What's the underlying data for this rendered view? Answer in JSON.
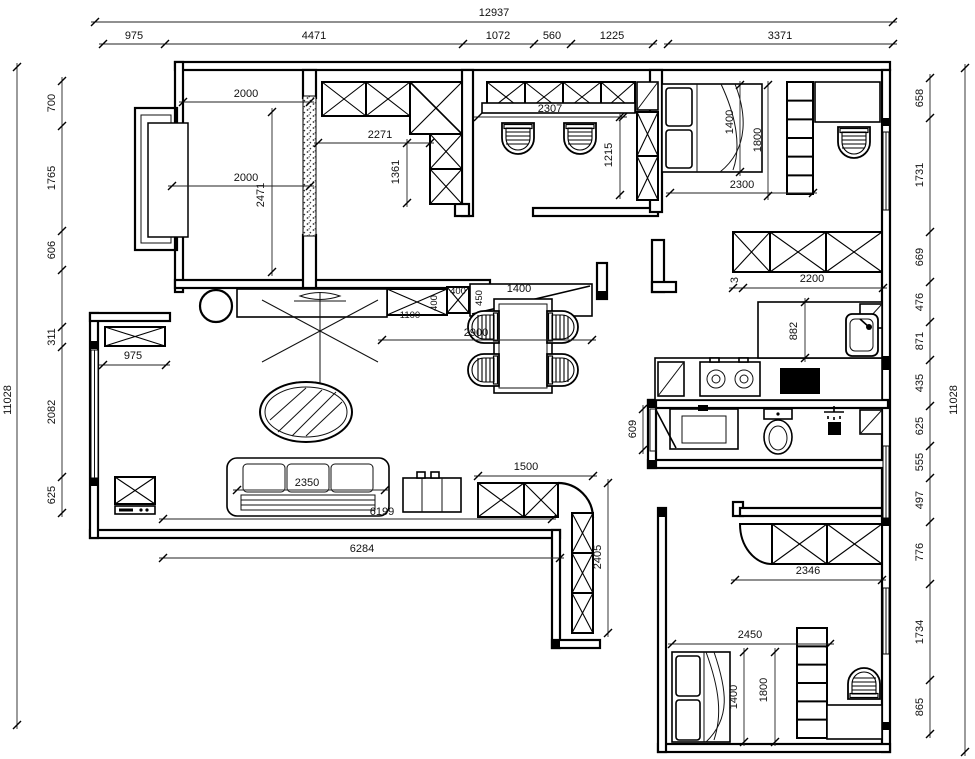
{
  "dims": {
    "top_total": "12937",
    "top": [
      "975",
      "4471",
      "1072",
      "560",
      "1225",
      "3371"
    ],
    "left_total": "11028",
    "left": [
      "700",
      "1765",
      "606",
      "311",
      "2082",
      "625"
    ],
    "right_total": "11028",
    "right": [
      "658",
      "1731",
      "669",
      "476",
      "871",
      "435",
      "625",
      "555",
      "497",
      "776",
      "1734",
      "865"
    ],
    "master": {
      "w1": "2000",
      "w2": "2000",
      "depth": "2471"
    },
    "study": {
      "w": "2271",
      "h": "1361"
    },
    "office": {
      "w": "2307",
      "h": "1215"
    },
    "bedroom_top": {
      "bed_w": "1400",
      "bed_l": "1800",
      "clear": "2300",
      "gap": "3",
      "wardrobe": "2200"
    },
    "kitchen": {
      "counter_h": "882"
    },
    "bath": {
      "door_w": "609"
    },
    "entry": {
      "shoe_cab": "975",
      "console": "1100",
      "d400a": "400",
      "d400b": "400",
      "d450": "450",
      "bar": "1400"
    },
    "dining": {
      "width": "2900"
    },
    "living": {
      "sofa": "2350",
      "length": "6199",
      "wall": "6284",
      "corner_cab_w": "1500",
      "corner_cab_h": "2405"
    },
    "bedroom_bottom": {
      "cab": "2346",
      "width": "2450",
      "bed_w": "1400",
      "bed_l": "1800"
    }
  }
}
